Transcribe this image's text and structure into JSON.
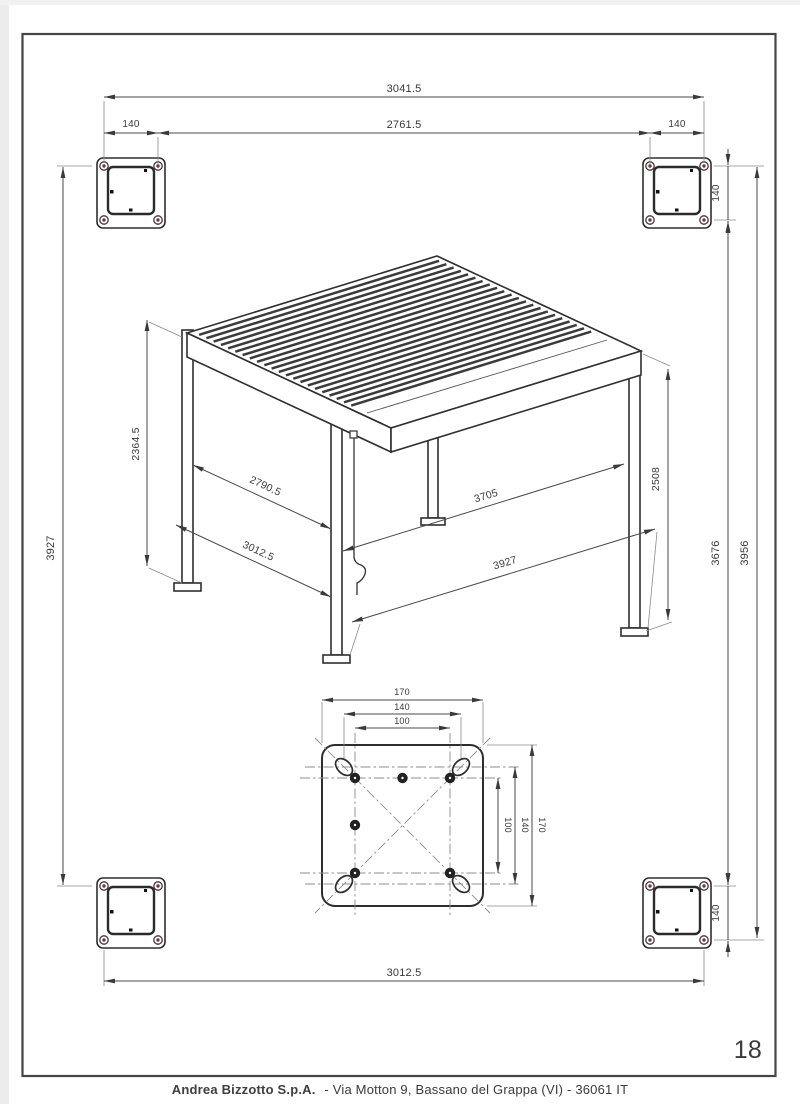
{
  "page": {
    "number": "18",
    "footer_company": "Andrea Bizzotto S.p.A.",
    "footer_rest": "- Via Motton 9, Bassano del Grappa (VI) - 36061 IT"
  },
  "plan": {
    "top": {
      "overall_width": "3041.5",
      "inner_width": "2761.5",
      "offset_left": "140",
      "offset_right": "140"
    },
    "left": {
      "height": "3927"
    },
    "right": {
      "post_top": "140",
      "height_inner": "3676",
      "height_outer": "3956",
      "post_bottom": "140"
    },
    "bottom": {
      "width": "3012.5"
    }
  },
  "isometric": {
    "post_height": "2364.5",
    "depth_inner": "2790.5",
    "depth_outer": "3012.5",
    "width_inner": "3705",
    "width_outer": "3927",
    "side_height": "2508"
  },
  "plate_detail": {
    "width_outer": "170",
    "width_holes": "140",
    "width_inner": "100",
    "height_outer": "170",
    "height_holes": "140",
    "height_inner": "100"
  },
  "colors": {
    "line": "#3a3a3a",
    "dim": "#4a4a4a",
    "bolt_hole": "#6b3c3c"
  }
}
